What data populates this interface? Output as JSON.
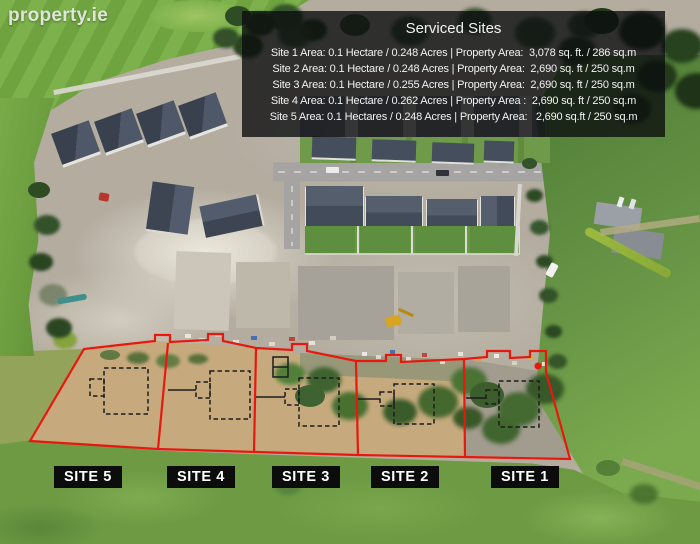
{
  "watermark": "property.ie",
  "info_panel": {
    "title": "Serviced Sites",
    "lines": [
      "Site 1 Area: 0.1 Hectare / 0.248 Acres | Property Area:  3,078 sq. ft. / 286 sq.m",
      "Site 2 Area: 0.1 Hectare / 0.248 Acres | Property Area:  2,690 sq. ft / 250 sq.m",
      "Site 3 Area: 0.1 Hectare / 0.255 Acres | Property Area:  2,690 sq. ft / 250 sq.m",
      "Site 4 Area: 0.1 Hectare / 0.262 Acres | Property Area :  2,690 sq. ft / 250 sq.m",
      "Site 5 Area: 0.1 Hectares / 0.248 Acres | Property Area:   2,690 sq.ft / 250 sq.m"
    ]
  },
  "site_labels": [
    {
      "label": "SITE 5"
    },
    {
      "label": "SITE 4"
    },
    {
      "label": "SITE 3"
    },
    {
      "label": "SITE 2"
    },
    {
      "label": "SITE 1"
    }
  ],
  "colors": {
    "plot_outline": "#e8180f",
    "house_footprint": "#1c1c1c",
    "label_bg": "#0c0c0c",
    "label_text": "#ffffff",
    "panel_bg": "rgba(10,11,14,0.78)",
    "panel_text": "#f2f2f2",
    "watermark_text": "#f2f2f2"
  }
}
